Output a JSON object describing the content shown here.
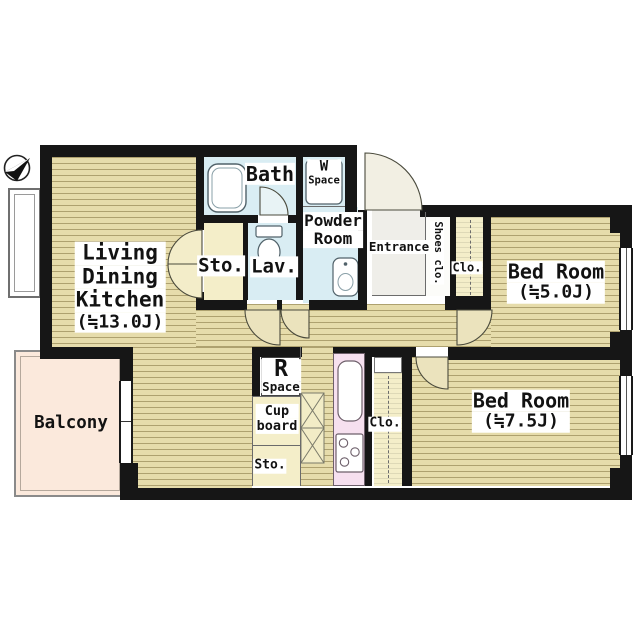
{
  "plan_title": "apartment-floor-plan",
  "labels": {
    "ldk": {
      "line1": "Living",
      "line2": "Dining",
      "line3": "Kitchen",
      "area": "(≒13.0J)"
    },
    "bath": {
      "label": "Bath"
    },
    "w_space": {
      "line1": "W",
      "line2": "Space"
    },
    "powder_room": {
      "line1": "Powder",
      "line2": "Room"
    },
    "sto_upper": {
      "label": "Sto."
    },
    "lav": {
      "label": "Lav."
    },
    "entrance": {
      "label": "Entrance"
    },
    "shoes_clo": {
      "label": "Shoes clo."
    },
    "clo_upper": {
      "label": "Clo."
    },
    "bedroom5": {
      "name": "Bed Room",
      "area": "(≒5.0J)"
    },
    "bedroom7": {
      "name": "Bed Room",
      "area": "(≒7.5J)"
    },
    "r_space": {
      "line1": "R",
      "line2": "Space"
    },
    "cupboard": {
      "line1": "Cup",
      "line2": "board"
    },
    "sto_lower": {
      "label": "Sto."
    },
    "clo_lower": {
      "label": "Clo."
    },
    "balcony": {
      "label": "Balcony"
    }
  },
  "palette": {
    "wall": "#161616",
    "wood_floor": "#e6dcab",
    "wet_area": "#d9edf3",
    "kitchen_counter": "#f6e0ef",
    "storage": "#f4eec9",
    "balcony": "#fbe9dc",
    "entrance": "#efeee9"
  },
  "icons": [
    "north-arrow-icon",
    "bathtub-icon",
    "washing-machine-icon",
    "toilet-icon",
    "washbasin-icon",
    "kitchen-sink-icon",
    "stove-icon",
    "counter-x-icon",
    "door-swing-icon",
    "window-icon",
    "sliding-door-icon",
    "bay-window-icon"
  ]
}
